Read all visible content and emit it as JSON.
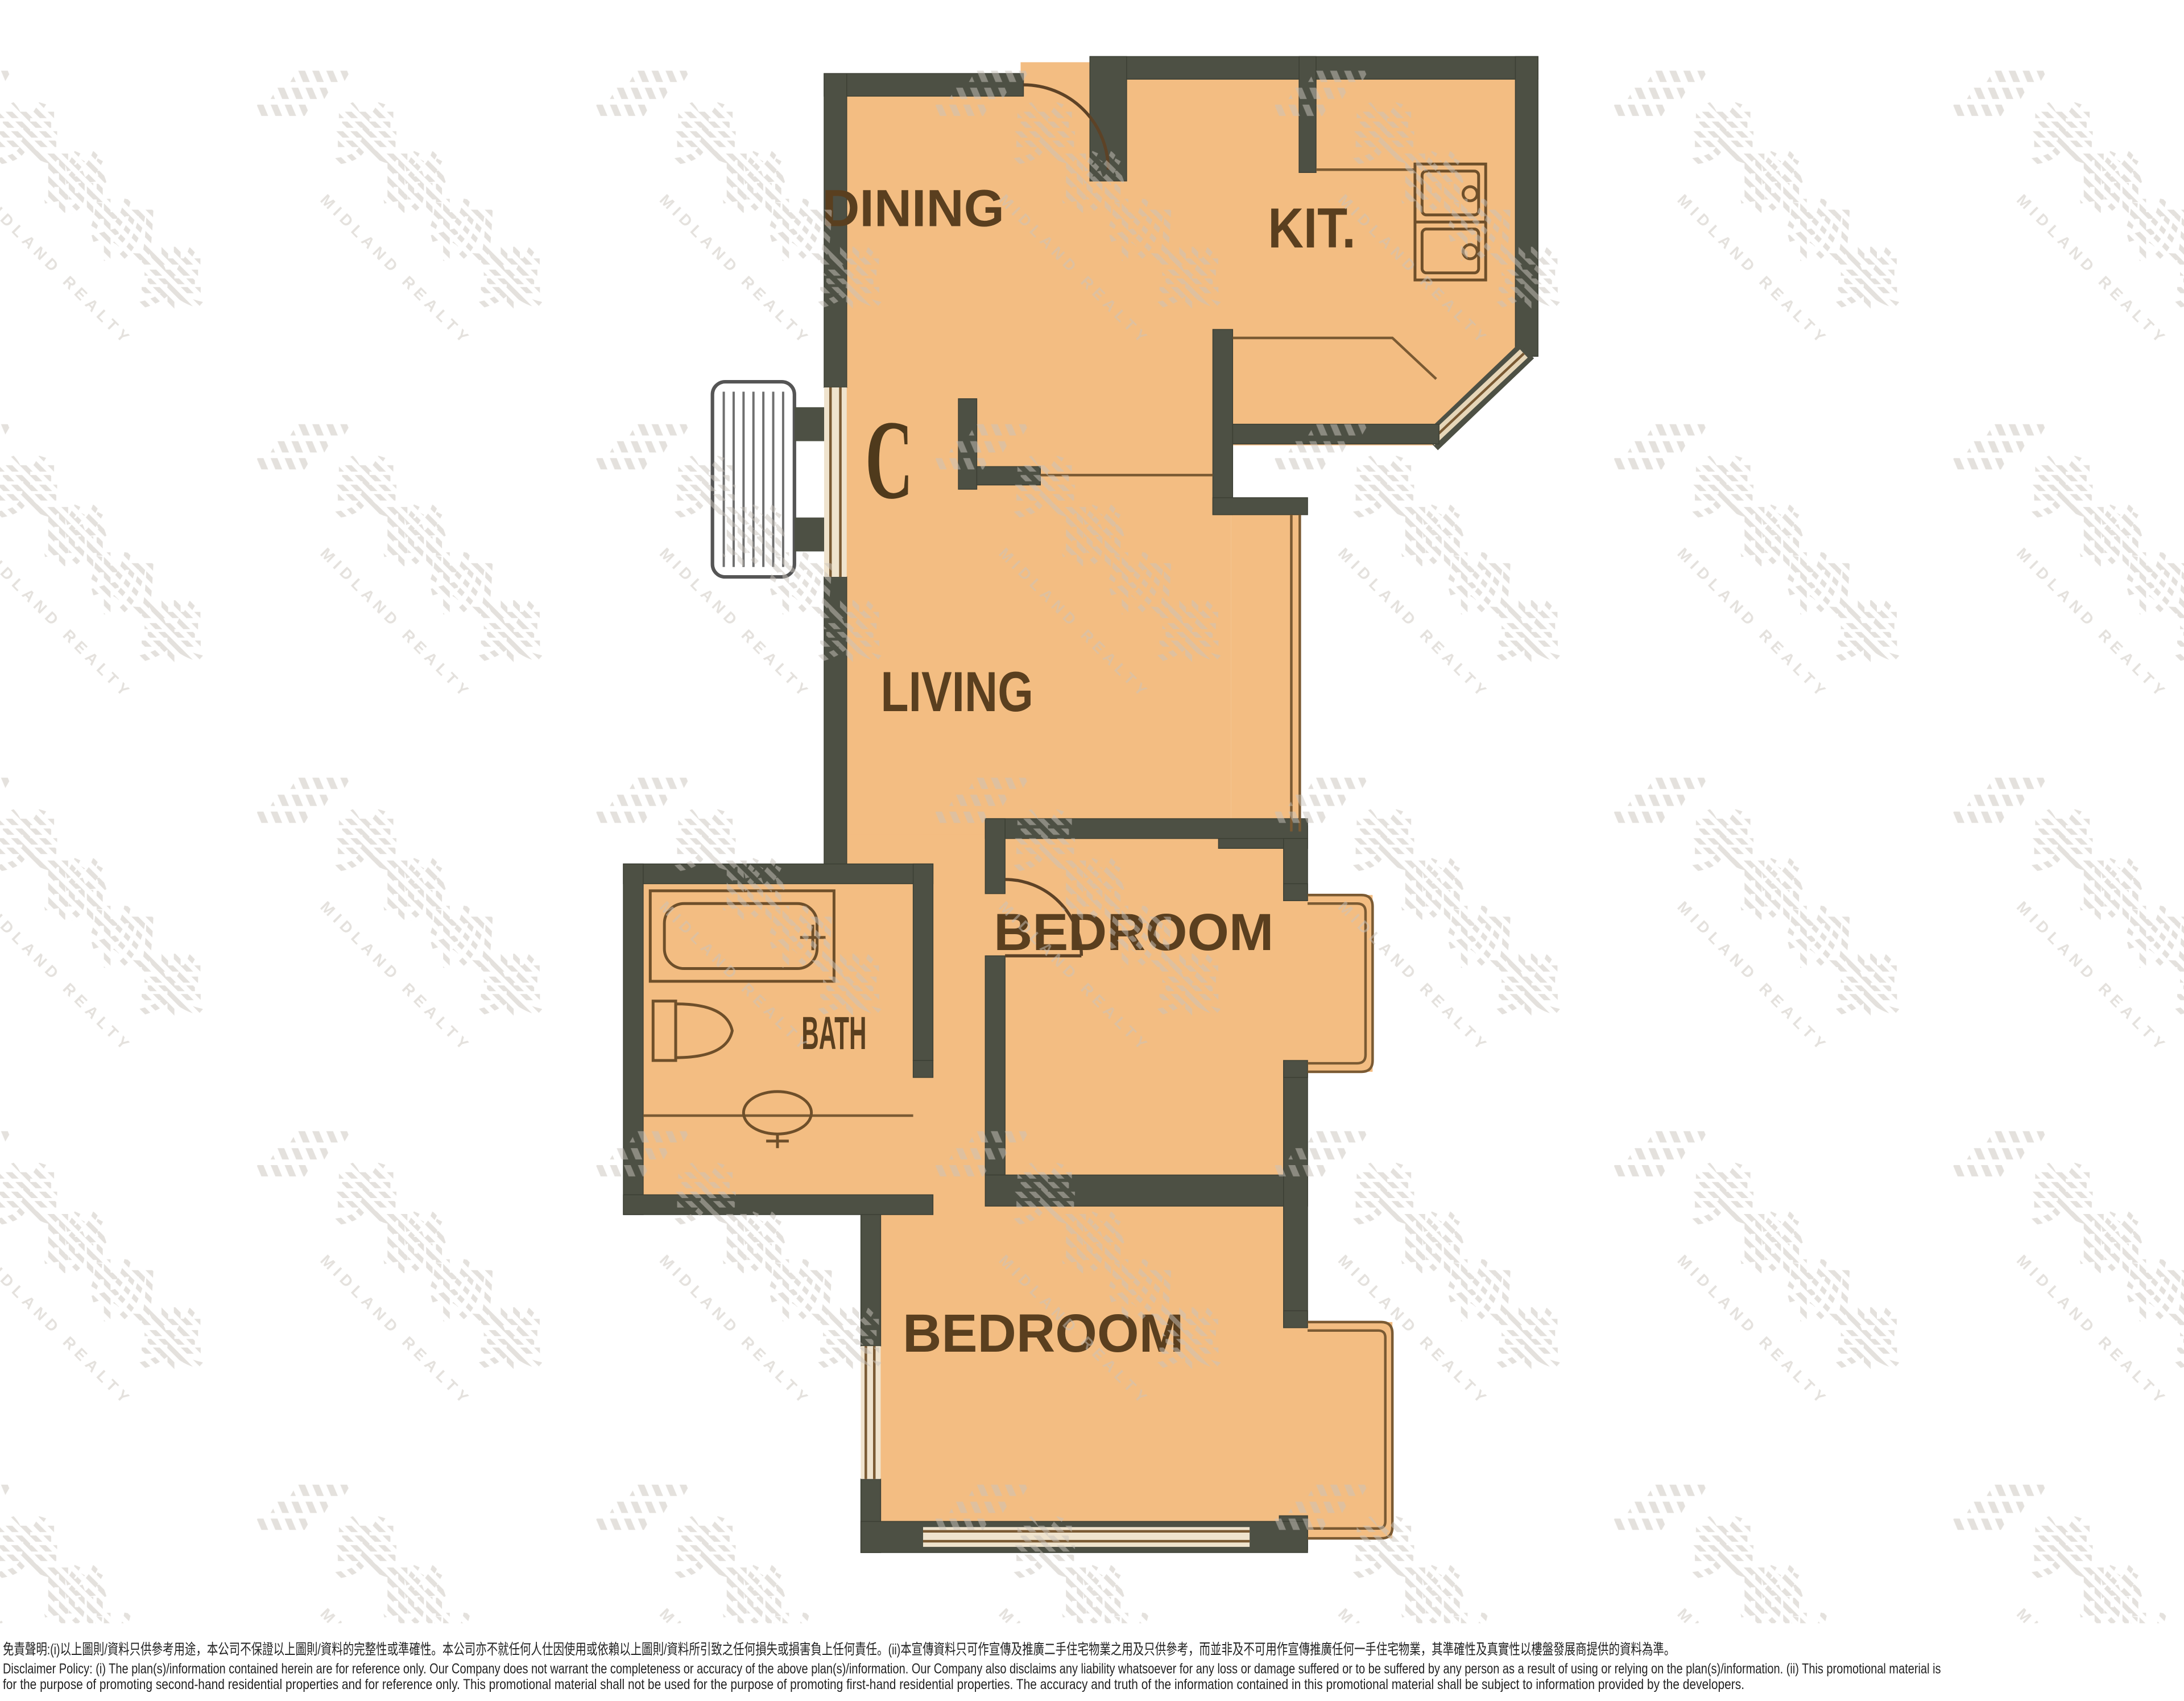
{
  "plan": {
    "unit_label": "C",
    "rooms": {
      "dining": "DINING",
      "kitchen": "KIT.",
      "living": "LIVING",
      "bedroom1": "BEDROOM",
      "bath": "BATH",
      "bedroom2": "BEDROOM"
    }
  },
  "watermark": {
    "chars": [
      "美",
      "聯",
      "物",
      "業"
    ],
    "latin": "MIDLAND REALTY"
  },
  "disclaimer": {
    "line1_zh": "免責聲明:(i)以上圖則/資料只供參考用途，本公司不保證以上圖則/資料的完整性或準確性。本公司亦不就任何人仕因使用或依賴以上圖則/資料所引致之任何損失或損害負上任何責任。(ii)本宣傳資料只可作宣傳及推廣二手住宅物業之用及只供參考，而並非及不可用作宣傳推廣任何一手住宅物業，其準確性及真實性以樓盤發展商提供的資料為準。",
    "line2_en": "Disclaimer Policy: (i) The plan(s)/information contained herein are for reference only. Our Company does not warrant the completeness or accuracy of the above plan(s)/information. Our Company also disclaims any liability whatsoever for any loss or damage suffered or to be suffered by any person as a result of using or relying on the plan(s)/information. (ii) This promotional material is",
    "line3_en": "for the purpose of promoting second-hand residential properties and for reference only. This promotional material shall not be used for the purpose of promoting first-hand residential properties. The accuracy and truth of the information contained in this promotional material shall be subject to information provided by the developers."
  },
  "colors": {
    "floor": "#f3bd82",
    "wall": "#4d5044",
    "fixture_line": "#7a5a33",
    "label_text": "#5a3f1f",
    "watermark": "#c9c3bb"
  }
}
